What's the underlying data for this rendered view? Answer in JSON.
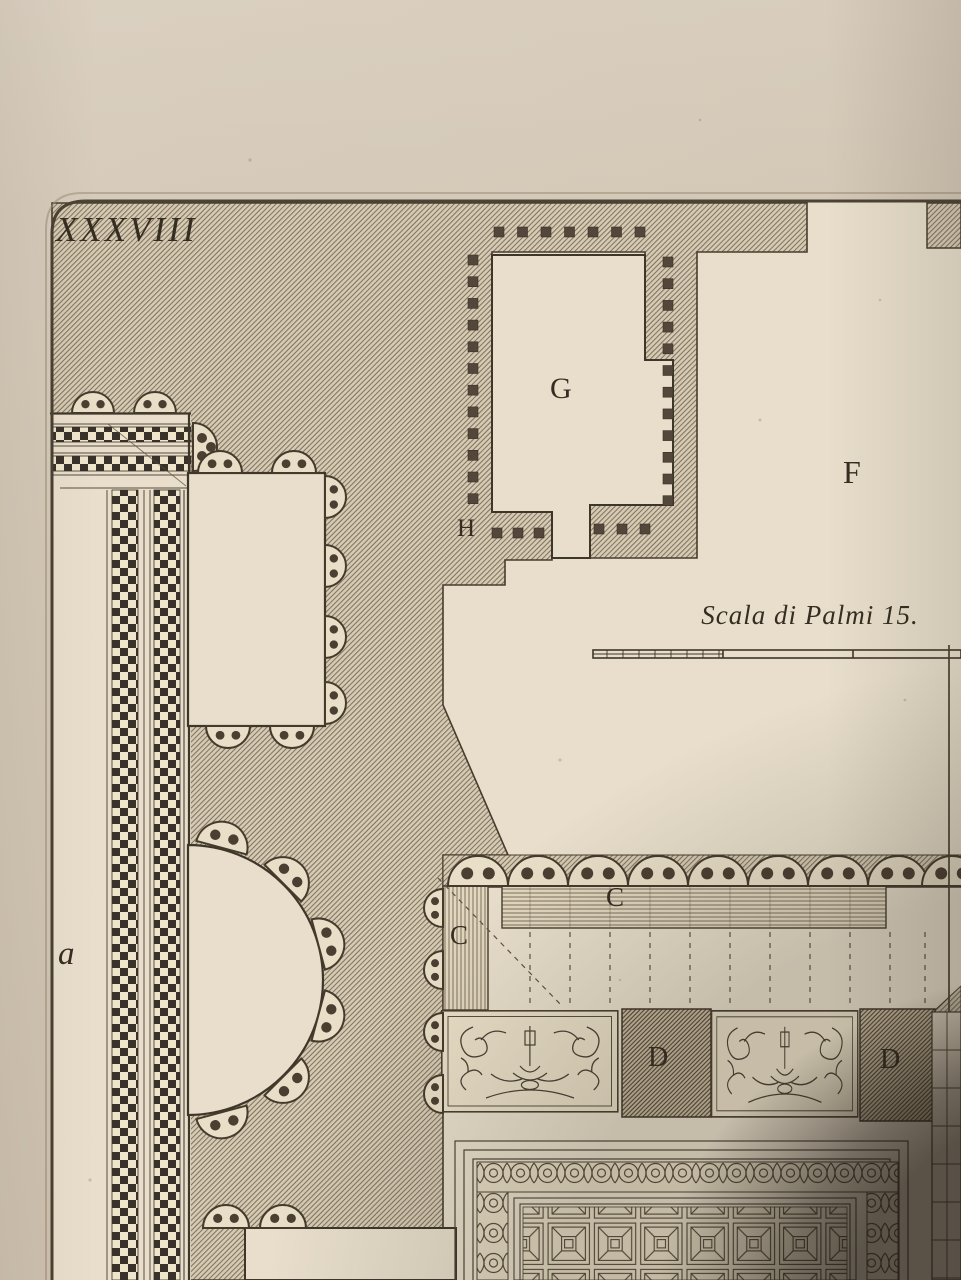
{
  "artwork": {
    "plate_number": "XXXVIII",
    "scale_caption": "Scala di Palmi 15.",
    "labels": {
      "room_g": "G",
      "hall_f": "F",
      "vestibule_h": "H",
      "c_left": "C",
      "c_band": "C",
      "pier_d_left": "D",
      "pier_d_right": "D",
      "corridor_a": "a"
    }
  },
  "colors": {
    "paper_margin": "#d3c7b6",
    "plate_paper": "#e8decb",
    "ink": "#41382b",
    "hatch_tone": "#b9ac96"
  }
}
